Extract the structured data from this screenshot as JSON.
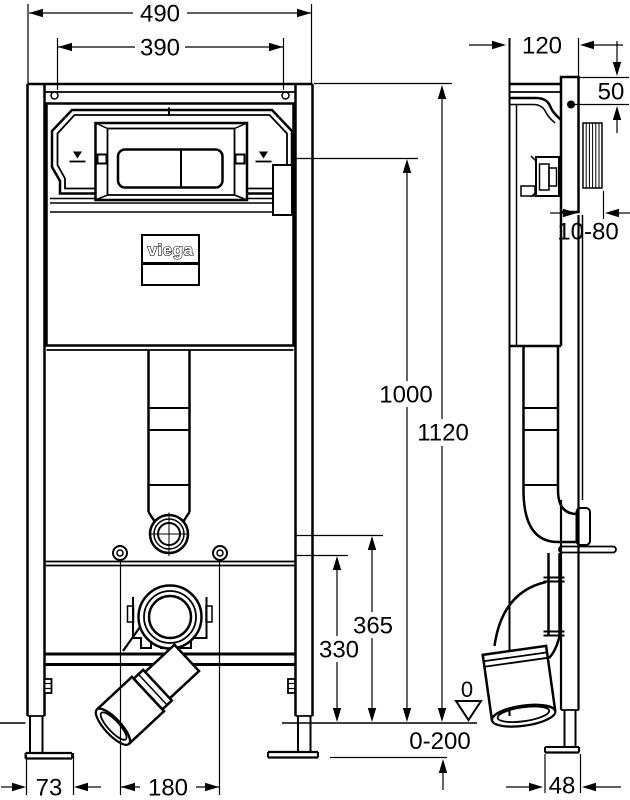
{
  "drawing": {
    "brand": "viega",
    "front_view": {
      "dim_overall_width": "490",
      "dim_plate_cutout_width": "390",
      "dim_total_height": "1120",
      "dim_flush_plate_height": "1000",
      "dim_flush_connection_height": "365",
      "dim_outlet_height": "330",
      "dim_foot_offset": "73",
      "dim_fixing_bolt_spacing": "180",
      "dim_floor_datum": "0",
      "dim_floor_adjustment": "0-200"
    },
    "side_view": {
      "dim_frame_depth": "120",
      "dim_top_clearance": "50",
      "dim_wall_finish_range": "10-80",
      "dim_foot_depth": "48"
    }
  }
}
